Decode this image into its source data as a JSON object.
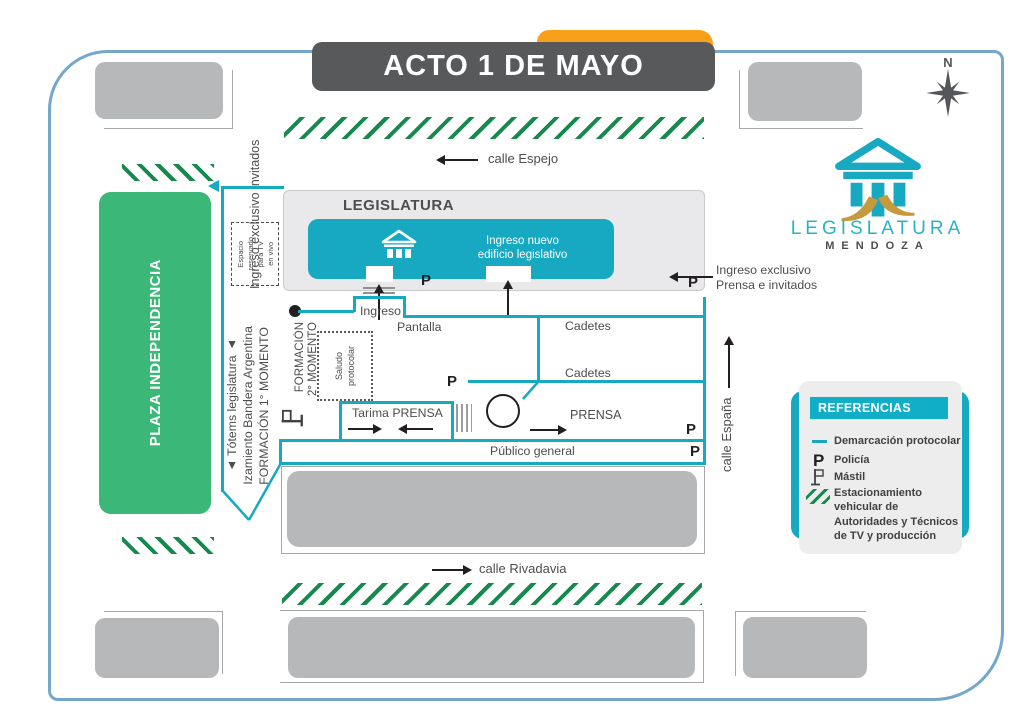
{
  "title": "ACTO 1 DE MAYO",
  "compass_label": "N",
  "logo": {
    "name": "LEGISLATURA",
    "city": "MENDOZA"
  },
  "streets": {
    "espejo": "calle Espejo",
    "rivadavia": "calle Rivadavia",
    "espana": "calle España"
  },
  "plaza_label": "PLAZA INDEPENDENCIA",
  "building": {
    "label": "LEGISLATURA",
    "entrance_line1": "Ingreso nuevo",
    "entrance_line2": "edificio legislativo"
  },
  "left_notes": {
    "invitados": "Ingreso exclusivo invitados",
    "totems": "▲ Tótems legislatura ▲",
    "izamiento": "Izamiento Bandera Argentina",
    "formacion1": "FORMACIÓN 1° MOMENTO",
    "formacion2_a": "FORMACIÓN",
    "formacion2_b": "2° MOMENTO",
    "tv_l1": "Espacio",
    "tv_l2": "reservado",
    "tv_l3": "para TV",
    "tv_l4": "en vivo",
    "saludo_a": "Saludo",
    "saludo_b": "protocolar"
  },
  "zones": {
    "ingreso": "Ingreso",
    "pantalla": "Pantalla",
    "cadetes_top": "Cadetes",
    "cadetes_bottom": "Cadetes",
    "tarima": "Tarima PRENSA",
    "prensa": "PRENSA",
    "publico": "Público general"
  },
  "right_notes": {
    "prensa_l1": "Ingreso exclusivo",
    "prensa_l2": "Prensa e invitados"
  },
  "police": "P",
  "legend": {
    "title": "REFERENCIAS",
    "demarcacion": "Demarcación protocolar",
    "policia": "Policía",
    "mastil": "Mástil",
    "estacionamiento": "Estacionamiento vehicular de Autoridades y Técnicos de TV y producción"
  },
  "colors": {
    "teal": "#16a9c1",
    "plaza_green": "#3bb878",
    "hatch_green": "#168a4e",
    "gray_block": "#b6b8ba",
    "dark_gray": "#58595b",
    "orange": "#f9a01b",
    "border_blue": "#74a7cc"
  }
}
